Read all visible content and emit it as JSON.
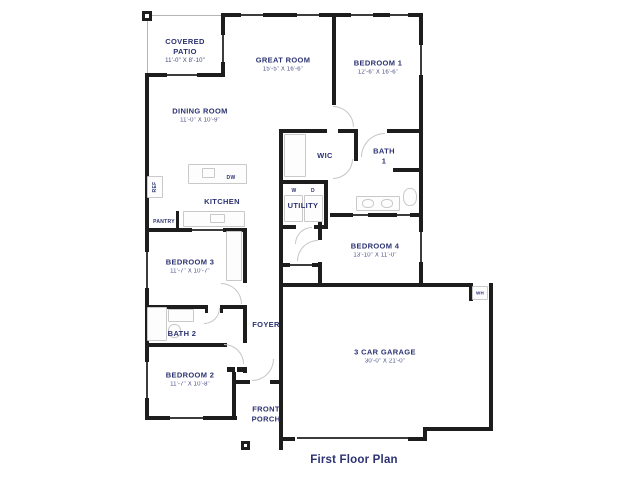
{
  "plan": {
    "title": "First Floor Plan",
    "colors": {
      "label": "#2c3272",
      "wall": "#1d1d1d"
    },
    "rooms": [
      {
        "id": "covered-patio",
        "name": "COVERED\nPATIO",
        "dims": "11'-0\" X 8'-10\""
      },
      {
        "id": "great-room",
        "name": "GREAT ROOM",
        "dims": "15'-5\" X 16'-6\""
      },
      {
        "id": "dining-room",
        "name": "DINING ROOM",
        "dims": "11'-0\" X 10'-9\""
      },
      {
        "id": "bedroom-1",
        "name": "BEDROOM 1",
        "dims": "12'-6\" X 16'-6\""
      },
      {
        "id": "wic",
        "name": "WIC",
        "dims": ""
      },
      {
        "id": "bath-1",
        "name": "BATH\n1",
        "dims": ""
      },
      {
        "id": "utility",
        "name": "UTILITY",
        "dims": ""
      },
      {
        "id": "kitchen",
        "name": "KITCHEN",
        "dims": ""
      },
      {
        "id": "bedroom-3",
        "name": "BEDROOM 3",
        "dims": "11'-7\" X 10'-7\""
      },
      {
        "id": "bedroom-4",
        "name": "BEDROOM 4",
        "dims": "13'-10\" X 11'-0\""
      },
      {
        "id": "bath-2",
        "name": "BATH 2",
        "dims": ""
      },
      {
        "id": "foyer",
        "name": "FOYER",
        "dims": ""
      },
      {
        "id": "bedroom-2",
        "name": "BEDROOM 2",
        "dims": "11'-7\" X 10'-8\""
      },
      {
        "id": "front-porch",
        "name": "FRONT\nPORCH",
        "dims": ""
      },
      {
        "id": "garage",
        "name": "3 CAR GARAGE",
        "dims": "30'-0\" X 21'-0\""
      }
    ],
    "appliances": {
      "refrigerator": "REF",
      "pantry": "PANTRY",
      "dishwasher": "DW",
      "washer": "W",
      "dryer": "D",
      "water_heater": "WH"
    }
  }
}
